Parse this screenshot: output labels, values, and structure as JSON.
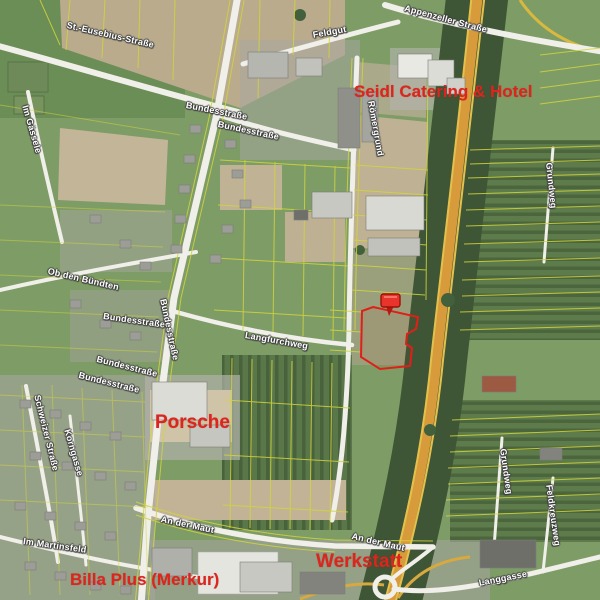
{
  "map": {
    "street_labels": [
      {
        "text": "St.-Eusebius-Straße"
      },
      {
        "text": "Feldgut"
      },
      {
        "text": "Appenzeller Straße"
      },
      {
        "text": "Im Gässele"
      },
      {
        "text": "Bundesstraße"
      },
      {
        "text": "Bundesstraße"
      },
      {
        "text": "Römergrund"
      },
      {
        "text": "Grundweg"
      },
      {
        "text": "Ob den Bündten"
      },
      {
        "text": "Bundesstraße"
      },
      {
        "text": "Bundesstraße"
      },
      {
        "text": "Langfurchweg"
      },
      {
        "text": "Bundesstraße"
      },
      {
        "text": "Bundesstraße"
      },
      {
        "text": "Schweizer Straße"
      },
      {
        "text": "Korngasse"
      },
      {
        "text": "Grundweg"
      },
      {
        "text": "Feldkreuzweg"
      },
      {
        "text": "An der Maut"
      },
      {
        "text": "An der Maut"
      },
      {
        "text": "Im Martinsfeld"
      },
      {
        "text": "Langgasse"
      }
    ],
    "poi_labels": [
      {
        "text": "Seidl Catering & Hotel"
      },
      {
        "text": "Porsche"
      },
      {
        "text": "Werkstatt"
      },
      {
        "text": "Billa Plus (Merkur)"
      }
    ],
    "marker": {
      "type": "red-pin-marker",
      "color": "#e8342b"
    },
    "highlighted_parcel": {
      "outline_color": "#e02018"
    },
    "colors": {
      "base_green": "#7e9c66",
      "dark_field_green": "#4b653d",
      "plowed_tan": "#bfae90",
      "road_white": "#f0efe9",
      "highway_orange": "#d89b3c",
      "parcel_yellow": "#d2d53c",
      "tree_dark": "#3e5636",
      "urban_gray": "#a9a8a2",
      "poi_red": "#dd241d",
      "street_label_white": "#ffffff"
    }
  }
}
